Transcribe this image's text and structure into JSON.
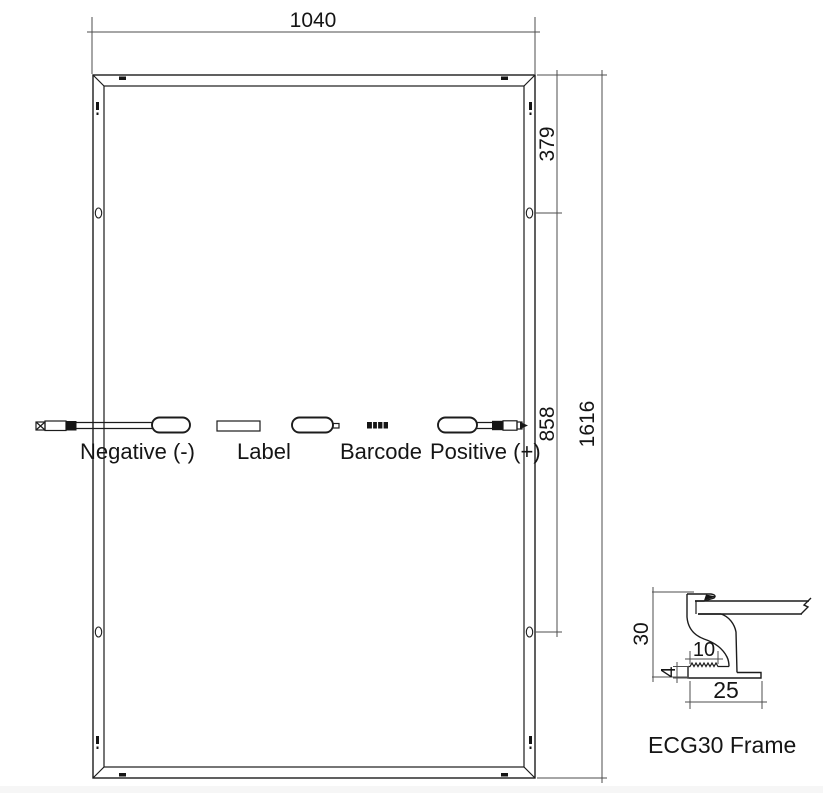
{
  "drawing": {
    "module": {
      "width_label": "1040",
      "height_label": "1616",
      "hole_top_label": "379",
      "hole_span_label": "858",
      "negative_label": "Negative (-)",
      "tag_label": "Label",
      "barcode_label": "Barcode",
      "positive_label": "Positive (+)"
    },
    "frame_detail": {
      "height_label": "30",
      "ledge_label": "10",
      "flange_thickness_label": "4",
      "flange_width_label": "25",
      "caption": "ECG30 Frame"
    },
    "colors": {
      "line": "#1c1c1c",
      "dimension_line": "#4e4e4e",
      "background": "#ffffff"
    }
  }
}
